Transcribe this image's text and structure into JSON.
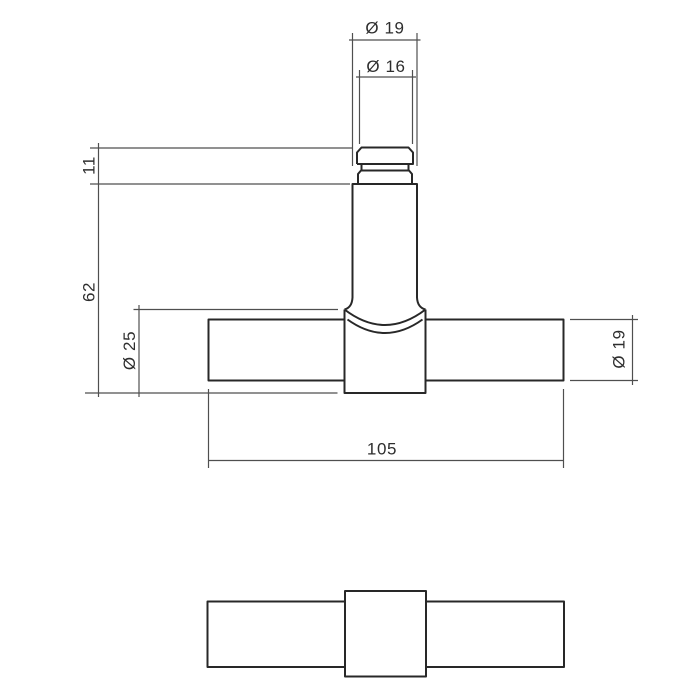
{
  "drawing": {
    "colors": {
      "background": "#ffffff",
      "object_line": "#282828",
      "dimension_line": "#4f4f4f",
      "text": "#2e2e2e"
    },
    "dimensions": {
      "stem_diameter": "Ø 19",
      "cap_diameter": "Ø 16",
      "cap_height": "11",
      "stem_length": "62",
      "center_diameter": "Ø 25",
      "bar_diameter": "Ø 19",
      "bar_length": "105"
    }
  }
}
